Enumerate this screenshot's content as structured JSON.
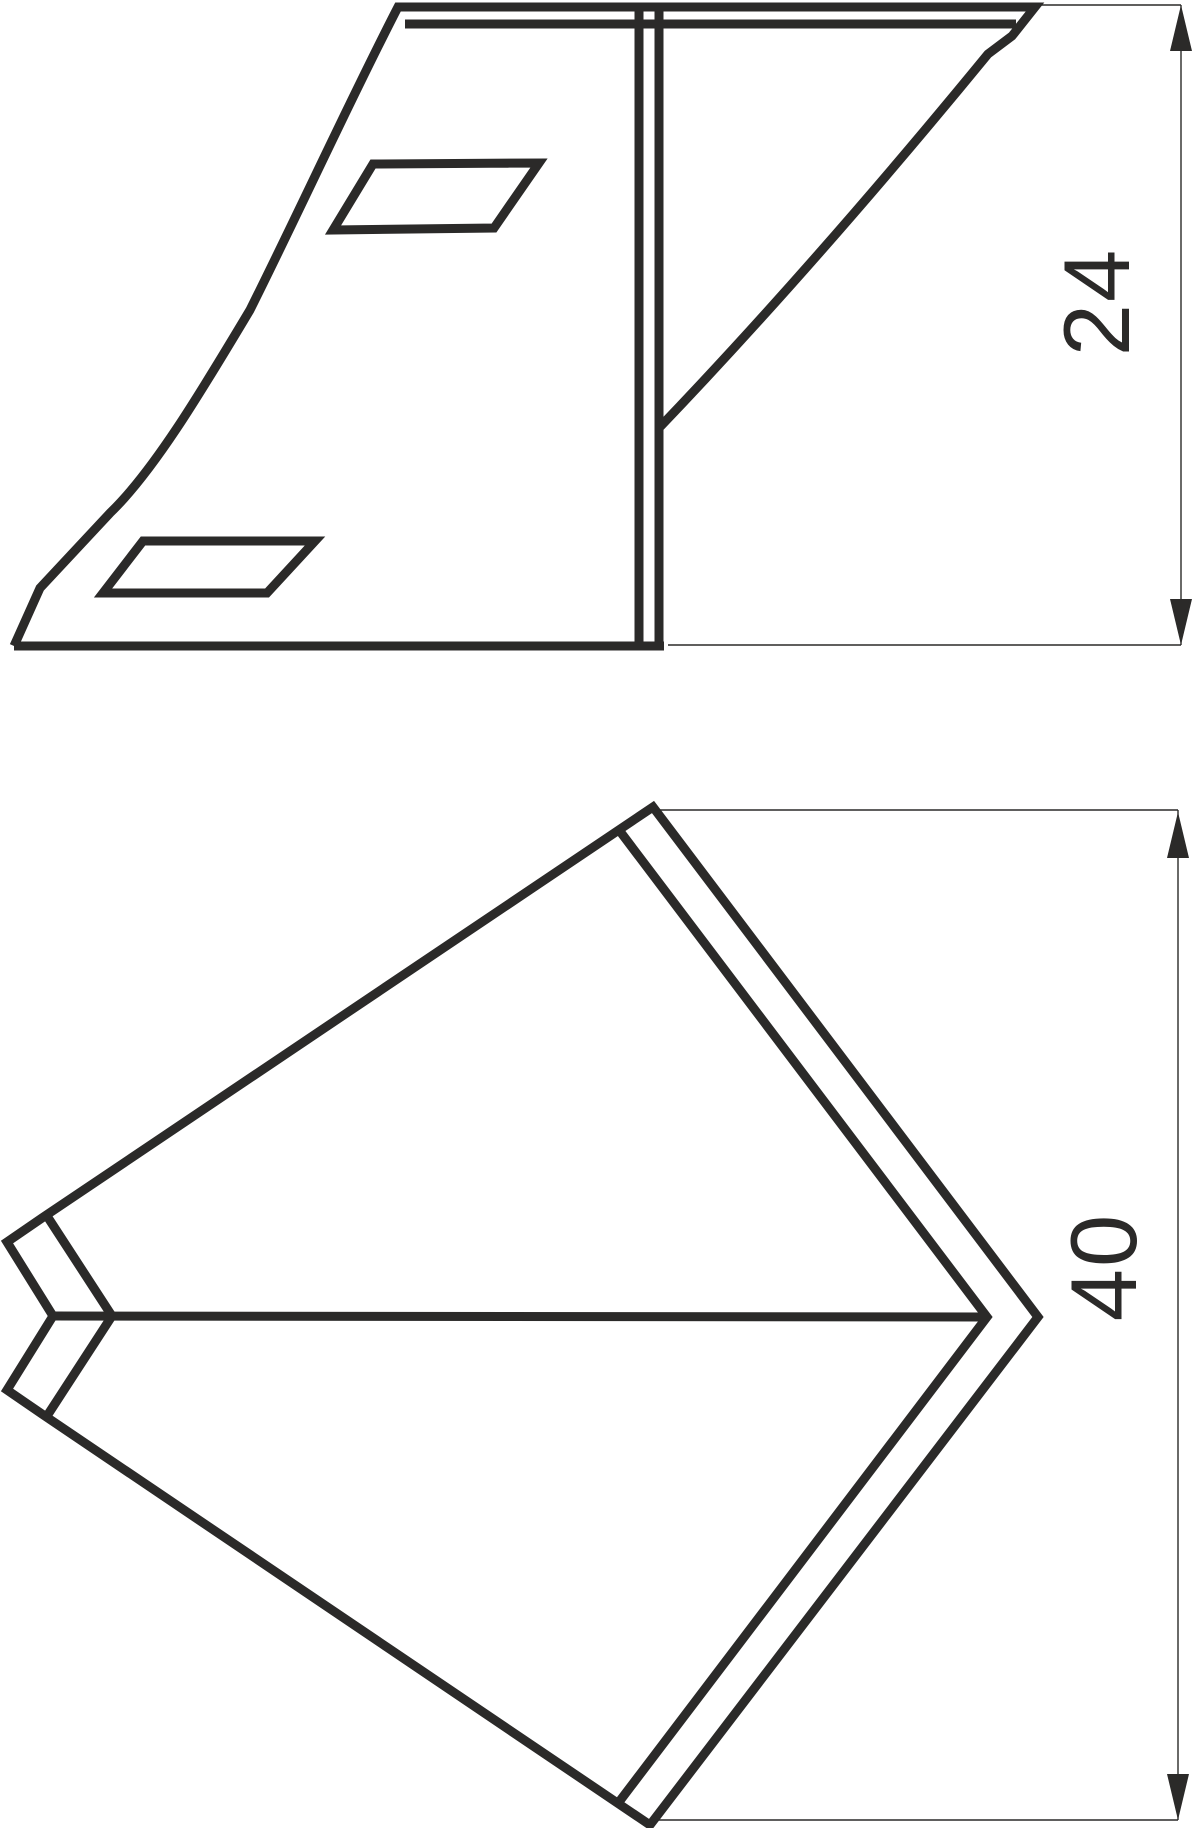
{
  "drawing": {
    "background_color": "#ffffff",
    "line_color": "#2b2a29",
    "views": [
      {
        "id": "side-view",
        "description": "curved blade profile with two parallelogram slot cutouts and double stem line"
      },
      {
        "id": "plan-view",
        "description": "kite-shaped plate with doubled thickness edges, V-notch at left vertex and crease midline"
      }
    ],
    "dimensions": [
      {
        "value": "24",
        "orientation": "rotated-90ccw",
        "side": "right-of-side-view"
      },
      {
        "value": "40",
        "orientation": "rotated-90ccw",
        "side": "right-of-plan-view"
      }
    ]
  }
}
